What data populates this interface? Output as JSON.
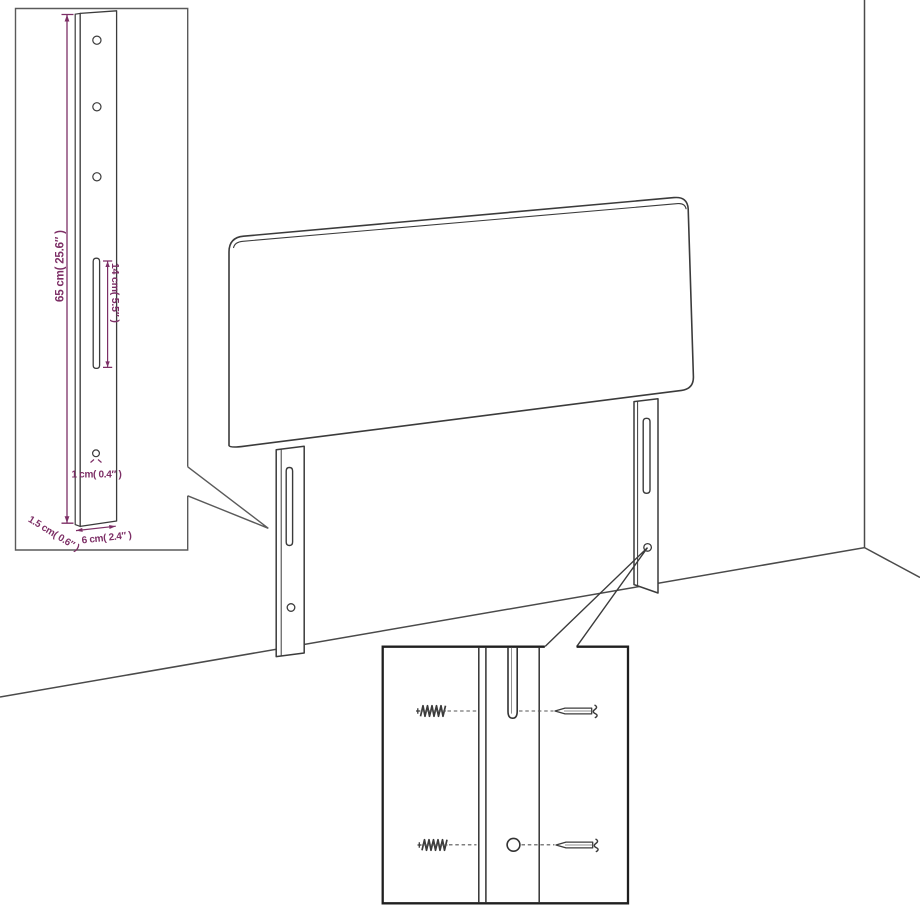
{
  "insets": {
    "leg_detail": {
      "dimensions": {
        "height": "65 cm( 25.6″ )",
        "slot_length": "14 cm( 5.5″ )",
        "hole_diameter": "1 cm( 0.4″ )",
        "board_thickness": "1.5 cm( 0.6″ )",
        "leg_width": "6 cm( 2.4″ )"
      }
    },
    "hardware_detail": {
      "icons": [
        "wood-screw-icon",
        "dowel-hole-icon",
        "machine-screw-icon",
        "mounting-slot-icon"
      ]
    }
  },
  "colors": {
    "background": "#ffffff",
    "line_art": "#3b3b3b",
    "dimension_accent": "#7d2f66",
    "detail_box_border": "#5a5a5a",
    "hardware_box_border": "#1f1f1f"
  }
}
